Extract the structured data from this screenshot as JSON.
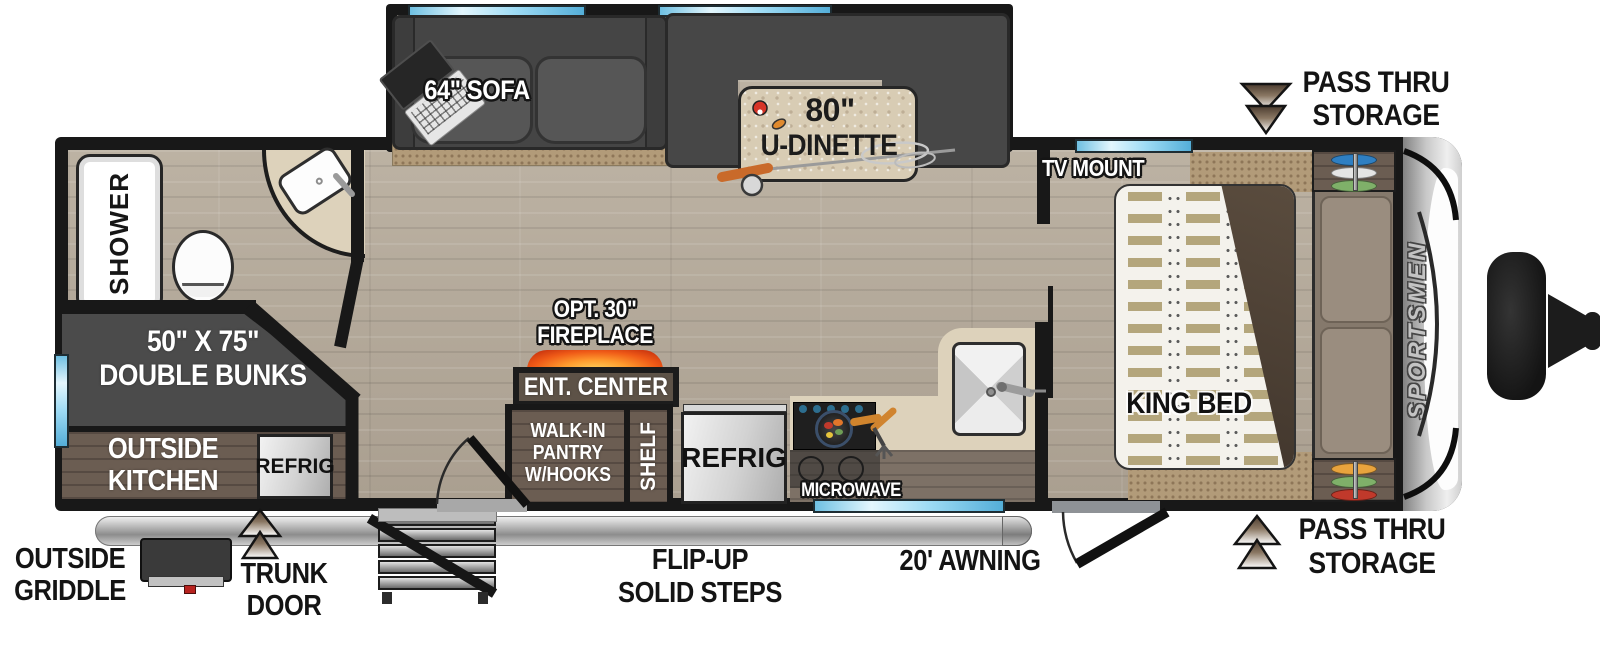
{
  "brand": "SPORTSMEN",
  "slideout": {
    "sofa_label": "64\" SOFA",
    "dinette_size": "80\"",
    "dinette_label": "U-DINETTE"
  },
  "bathroom": {
    "shower": "SHOWER"
  },
  "bunks": {
    "size": "50\" X 75\"",
    "label": "DOUBLE BUNKS"
  },
  "outside_kitchen": {
    "line1": "OUTSIDE",
    "line2": "KITCHEN",
    "refrig": "REFRIG"
  },
  "galley": {
    "fireplace_opt": "OPT. 30\"",
    "fireplace": "FIREPLACE",
    "ent_center": "ENT. CENTER",
    "pantry1": "WALK-IN",
    "pantry2": "PANTRY",
    "pantry3": "W/HOOKS",
    "shelf": "SHELF",
    "refrig": "REFRIG",
    "microwave": "MICROWAVE"
  },
  "bedroom": {
    "tv_mount": "TV MOUNT",
    "king_bed": "KING BED"
  },
  "exterior": {
    "pass_thru_line1": "PASS THRU",
    "pass_thru_line2": "STORAGE",
    "griddle1": "OUTSIDE",
    "griddle2": "GRIDDLE",
    "trunk1": "TRUNK",
    "trunk2": "DOOR",
    "steps1": "FLIP-UP",
    "steps2": "SOLID STEPS",
    "awning": "20' AWNING"
  },
  "colors": {
    "wall": "#181818",
    "window_glass": "#9fdcf5",
    "furniture_gray": "#4b4b4b",
    "carpet_tan": "#b29b79",
    "counter_cream": "#ddd2bb",
    "cabinet_brown": "#6b5d52",
    "flame_accent": "#ef5a17",
    "arrow_brown": "#4a3b2e"
  }
}
